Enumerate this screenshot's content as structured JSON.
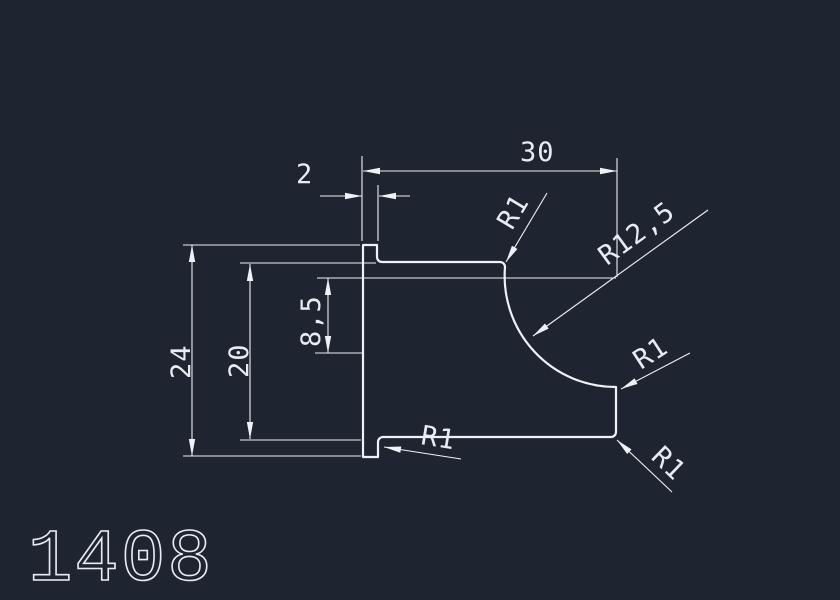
{
  "drawing": {
    "part_number": "1408",
    "dimensions": {
      "overall_width": "30",
      "tab_thickness": "2",
      "overall_height": "24",
      "inner_height": "20",
      "arc_center_offset": "8,5"
    },
    "radii": {
      "top_fillet": "R1",
      "concave_arc": "R12,5",
      "mid_right_fillet": "R1",
      "bottom_right_fillet": "R1",
      "bottom_left_fillet": "R1"
    },
    "colors": {
      "background": "#1f2530",
      "line": "#eef1f5",
      "text": "#e8ecf2"
    }
  }
}
